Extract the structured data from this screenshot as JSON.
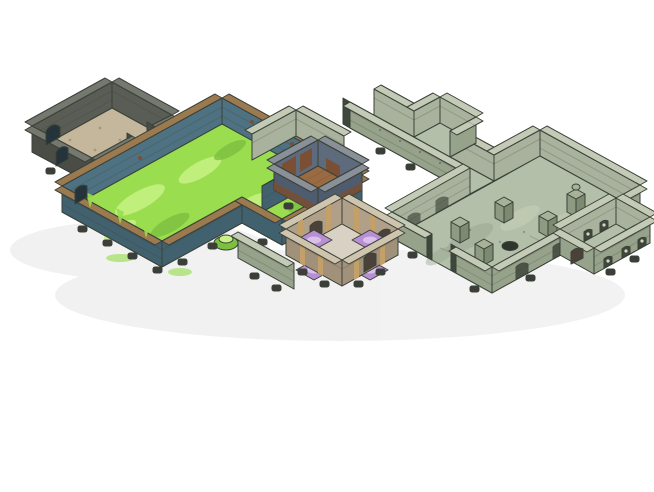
{
  "window": {
    "background": "#ffffff"
  },
  "palette": {
    "background": "#ffffff",
    "ink": "#3a4138",
    "shadow": "#000000",
    "gray_wall_face": "#5a5d55",
    "gray_wall_dark": "#4a4d46",
    "gray_wall_cap": "#75786f",
    "gray_floor": "#c4b79c",
    "gray_floor_speckle": "#a5987b",
    "teal_wall_face": "#4e7282",
    "teal_wall_front": "#41616f",
    "teal_wall_cap": "#9c7a50",
    "slime_floor": "#9ade4f",
    "slime_light": "#c8f285",
    "slime_dark": "#7dbf3f",
    "wood_wall_face": "#5d6b7d",
    "wood_wall_front": "#4f5c6d",
    "wood_wall_cap": "#8a9097",
    "wood_panel": "#7a4f33",
    "wood_floor": "#9a6b42",
    "wood_plank_line": "#6f4a2c",
    "pale_wall_face": "#a9b29d",
    "pale_wall_front": "#97a28b",
    "pale_wall_cap": "#c3cab5",
    "pale_floor": "#b3bfa9",
    "pale_floor_dark": "#9aa78f",
    "pale_floor_light": "#c6cfb8",
    "niche_dark": "#3f463c",
    "skull": "#d8d4c2",
    "purple_wall_face": "#b0a089",
    "purple_wall_front": "#a2917a",
    "purple_wall_cap": "#cfc4ae",
    "purple_gold": "#c2a068",
    "purple_floor_path": "#d9d2c4",
    "purple_tile": "#b98fd4",
    "purple_tile_light": "#dcc6ee",
    "arch_dark": "#4a4238",
    "pillar_top": "#a7b299",
    "pillar_left": "#8e9a82",
    "pillar_right": "#7d8a72",
    "hole_dark": "#2f352c",
    "foot_dark": "#3b3e39",
    "door_dark": "#25333b"
  },
  "scene": {
    "type": "isometric-dungeon-terrain-model",
    "rooms": [
      {
        "id": "ruined-stone-room",
        "floor": "tan-cobblestone",
        "walls": "dark-gray-stone"
      },
      {
        "id": "slime-hall",
        "floor": "green-slime",
        "walls": "teal-stone-tan-trim",
        "slime_mounds": 1
      },
      {
        "id": "wood-floor-room",
        "floor": "wood-planks",
        "walls": "blue-stone-with-brown-panels"
      },
      {
        "id": "ritual-chamber",
        "floor": "stone-cross-paths",
        "walls": "ornate-tan-stone",
        "purple_tiles": 4
      },
      {
        "id": "guard-alcove",
        "floor": "pale-stone",
        "walls": "pale-green-stone"
      },
      {
        "id": "long-corridor",
        "floor": "pale-stone",
        "walls": "pale-green-stone"
      },
      {
        "id": "pillared-hall",
        "floor": "pale-stone",
        "walls": "pale-green-stone",
        "pillars": 4,
        "statues": 1,
        "floor_holes": 1
      },
      {
        "id": "crypt-gallery",
        "floor": "pale-stone",
        "walls": "skull-niche-stone",
        "skull_niches": 6
      }
    ],
    "details": {
      "wall_feet_clips": "dark-plastic",
      "door_arches": 7
    }
  }
}
